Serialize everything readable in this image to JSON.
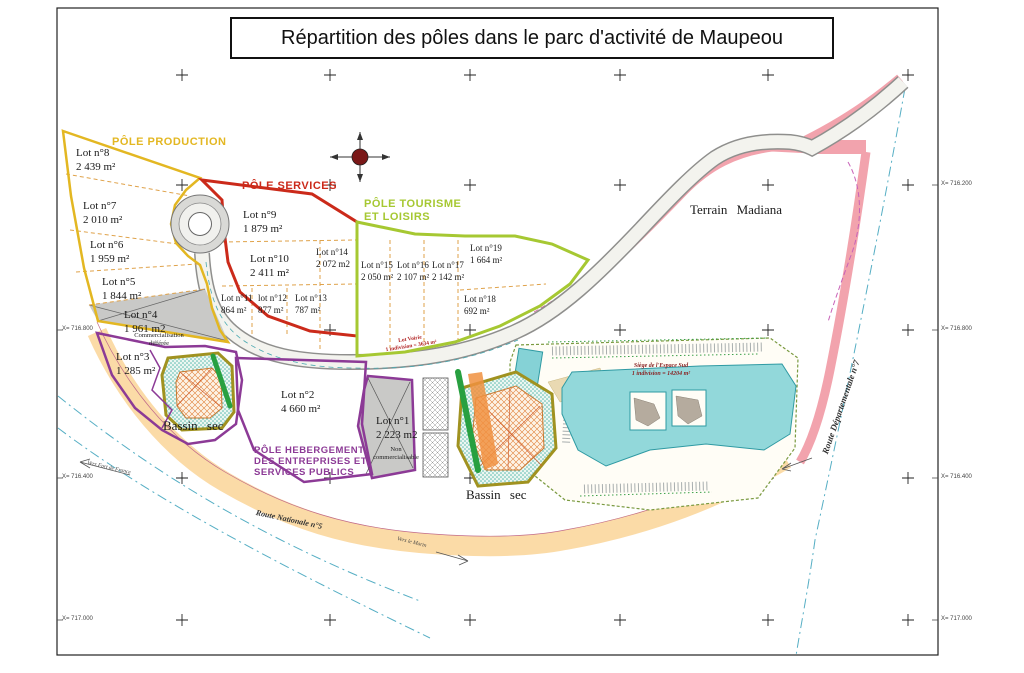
{
  "title": "Répartition des pôles dans le parc d'activité de Maupeou",
  "zones": {
    "production": "PÔLE PRODUCTION",
    "services": "PÔLE SERVICES",
    "tourisme_l1": "PÔLE TOURISME",
    "tourisme_l2": "ET LOISIRS",
    "hebergement_l1": "PÔLE HEBERGEMENT",
    "hebergement_l2": "DES ENTREPRISES ET",
    "hebergement_l3": "SERVICES PUBLICS"
  },
  "lots": [
    {
      "name": "Lot n°1",
      "area": "2 223 m2",
      "note1": "Non",
      "note2": "commercialisable"
    },
    {
      "name": "Lot n°2",
      "area": "4 660 m²"
    },
    {
      "name": "Lot n°3",
      "area": "1 285 m²"
    },
    {
      "name": "Lot n°4",
      "area": "1 961 m2",
      "note1": "Commercialisation",
      "note2": "différée"
    },
    {
      "name": "Lot n°5",
      "area": "1 844 m²"
    },
    {
      "name": "Lot n°6",
      "area": "1 959 m²"
    },
    {
      "name": "Lot n°7",
      "area": "2 010 m²"
    },
    {
      "name": "Lot n°8",
      "area": "2 439 m²"
    },
    {
      "name": "Lot n°9",
      "area": "1 879 m²"
    },
    {
      "name": "Lot n°10",
      "area": "2 411 m²"
    },
    {
      "name": "Lot n°11",
      "area": "864 m²"
    },
    {
      "name": "lot n°12",
      "area": "877 m²"
    },
    {
      "name": "Lot n°13",
      "area": "787 m²"
    },
    {
      "name": "Lot n°14",
      "area": "2 072 m2"
    },
    {
      "name": "Lot n°15",
      "area": "2 050 m²"
    },
    {
      "name": "Lot n°16",
      "area": "2 107 m²"
    },
    {
      "name": "Lot n°17",
      "area": "2 142 m²"
    },
    {
      "name": "Lot n°18",
      "area": "692 m²"
    },
    {
      "name": "Lot n°19",
      "area": "1 664 m²"
    }
  ],
  "places": {
    "terrain_madiana": "Terrain Madiana",
    "bassin_sec": "Bassin sec"
  },
  "roads": {
    "rn5": "Route Nationale n°5",
    "rd7": "Route Départementale n°7",
    "vers_fort_de_france": "Vers Fort de France",
    "vers_le_marin": "Vers le Marin"
  },
  "annotations": {
    "lot_voirie_l1": "Lot Voirie",
    "lot_voirie_l2": "1 indivision = 3634 m²",
    "siege_l1": "Siège de l'Espace Sud",
    "siege_l2": "1 indivision = 14204 m²"
  },
  "grid_labels": {
    "left": [
      "X= 716.800",
      "X= 716.400",
      "X= 717.000"
    ],
    "right": [
      "X= 716.200",
      "X= 716.800",
      "X= 716.400",
      "X= 717.000"
    ]
  },
  "colors": {
    "production": "#e3b722",
    "services": "#cb2a1a",
    "tourisme": "#a6c832",
    "hebergement": "#8c3a96",
    "terrain_border": "#f2a3ad",
    "rn5_band": "#fbd9a2",
    "building": "#92d8da",
    "stream": "#55aec4"
  }
}
